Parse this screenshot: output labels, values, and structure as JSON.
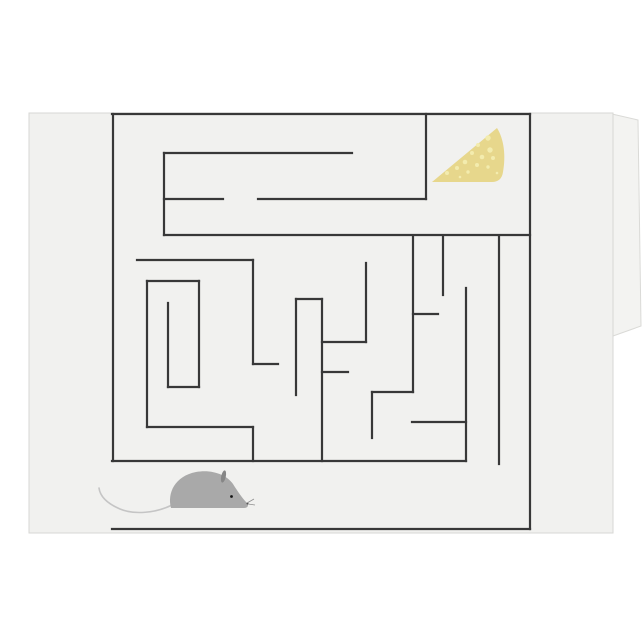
{
  "scene": {
    "description": "Tent-folded greeting card mockup printed with a mouse-and-cheese maze puzzle",
    "background_color": "#ffffff",
    "width": 644,
    "height": 644
  },
  "card": {
    "front": {
      "x": 29,
      "y": 113,
      "width": 584,
      "height": 420,
      "fill": "#f1f1ef",
      "edge_color": "#d7d7d4"
    },
    "back_flap": {
      "points": "612,114 638,120 641,326 613,336",
      "fill": "#f3f3f1",
      "edge_color": "#dadad7"
    }
  },
  "maze": {
    "wall_color": "#383838",
    "wall_width": 2.2,
    "walls": [
      [
        112,
        114,
        530,
        114
      ],
      [
        164,
        153,
        352,
        153
      ],
      [
        164,
        199,
        223,
        199
      ],
      [
        258,
        199,
        426,
        199
      ],
      [
        164,
        235,
        530,
        235
      ],
      [
        137,
        260,
        253,
        260
      ],
      [
        296,
        299,
        322,
        299
      ],
      [
        322,
        342,
        366,
        342
      ],
      [
        322,
        372,
        348,
        372
      ],
      [
        253,
        364,
        278,
        364
      ],
      [
        147,
        281,
        199,
        281
      ],
      [
        168,
        387,
        199,
        387
      ],
      [
        147,
        427,
        253,
        427
      ],
      [
        372,
        392,
        413,
        392
      ],
      [
        413,
        314,
        438,
        314
      ],
      [
        412,
        422,
        466,
        422
      ],
      [
        112,
        461,
        466,
        461
      ],
      [
        112,
        529,
        530,
        529
      ],
      [
        113,
        114,
        113,
        461
      ],
      [
        530,
        114,
        530,
        529
      ],
      [
        426,
        114,
        426,
        199
      ],
      [
        164,
        153,
        164,
        235
      ],
      [
        147,
        281,
        147,
        427
      ],
      [
        199,
        281,
        199,
        387
      ],
      [
        168,
        303,
        168,
        387
      ],
      [
        253,
        260,
        253,
        364
      ],
      [
        253,
        427,
        253,
        461
      ],
      [
        296,
        299,
        296,
        395
      ],
      [
        322,
        299,
        322,
        461
      ],
      [
        366,
        263,
        366,
        342
      ],
      [
        372,
        392,
        372,
        438
      ],
      [
        413,
        236,
        413,
        392
      ],
      [
        443,
        236,
        443,
        295
      ],
      [
        466,
        288,
        466,
        461
      ],
      [
        499,
        236,
        499,
        464
      ]
    ]
  },
  "cheese": {
    "body_path": "M497,128 C504,139 506,156 503,172 C502,179 498,182 492,182 L432,182 Z",
    "fill": "#e7d78c",
    "hole_fill": "#f3ecae",
    "holes": [
      [
        488,
        138,
        2.7
      ],
      [
        478,
        145,
        2
      ],
      [
        490,
        150,
        2.7
      ],
      [
        472,
        153,
        2
      ],
      [
        482,
        157,
        2.3
      ],
      [
        493,
        158,
        2
      ],
      [
        465,
        162,
        2.3
      ],
      [
        477,
        165,
        2
      ],
      [
        488,
        167,
        1.7
      ],
      [
        457,
        168,
        2
      ],
      [
        468,
        172,
        1.7
      ],
      [
        447,
        173,
        2
      ],
      [
        460,
        177,
        1.3
      ],
      [
        497,
        173,
        1.3
      ]
    ]
  },
  "mouse": {
    "body_path": "M171,508 C167,493 175,476 196,472 C212,469 227,475 233,484 C238,492 243,499 247,503 C249,505 248,508 244,508 Z",
    "body_fill": "#a9a9a9",
    "ear": {
      "cx": 223.5,
      "cy": 476.5,
      "rx": 2.3,
      "ry": 6.2,
      "rotate": 12,
      "fill": "#868686"
    },
    "eye": {
      "cx": 231.5,
      "cy": 496.5,
      "r": 1.4,
      "fill": "#151515"
    },
    "nose": {
      "cx": 247.5,
      "cy": 503.5,
      "r": 1,
      "fill": "#4a4a4a"
    },
    "whiskers": {
      "path": "M247,503 L254,499 M248,504 L255,505",
      "color": "#8f8f8f",
      "width": 0.8
    },
    "tail": {
      "path": "M172,505 C156,513 134,515 120,509 C106,503 100,496 99,488",
      "color": "#c5c5c5",
      "width": 1.6
    }
  }
}
